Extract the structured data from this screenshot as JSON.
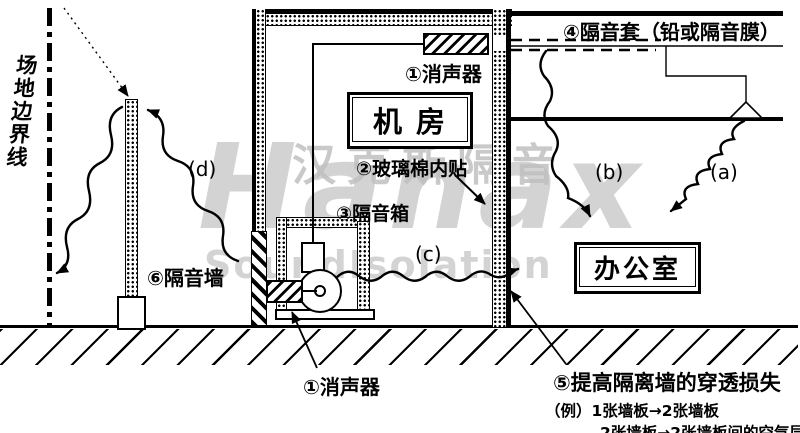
{
  "watermark": {
    "latin": "Hanax",
    "cn": "汉克斯隔音",
    "en": "SoundIsolation"
  },
  "site_boundary_label": "场地边界线",
  "rooms": {
    "machine_room": "机 房",
    "office": "办公室"
  },
  "annotations": {
    "silencer_top": "①消声器",
    "glass_wool": "②玻璃棉内贴",
    "sound_box": "③隔音箱",
    "sleeve": "④隔音套（铅或隔音膜）",
    "partition_title": "⑤提高隔离墙的穿透损失",
    "partition_example_1": "（例）1张墙板→2张墙板",
    "partition_example_2": "2张墙板→2张墙板间的空气层",
    "sound_wall": "⑥隔音墙",
    "silencer_bottom": "①消声器"
  },
  "paths": {
    "a": "(a)",
    "b": "(b)",
    "c": "(c)",
    "d": "(d)"
  },
  "colors": {
    "ink": "#000000",
    "paper": "#ffffff",
    "watermark_gray": "#c6c6c6",
    "watermark_light": "#d0d0d0"
  }
}
